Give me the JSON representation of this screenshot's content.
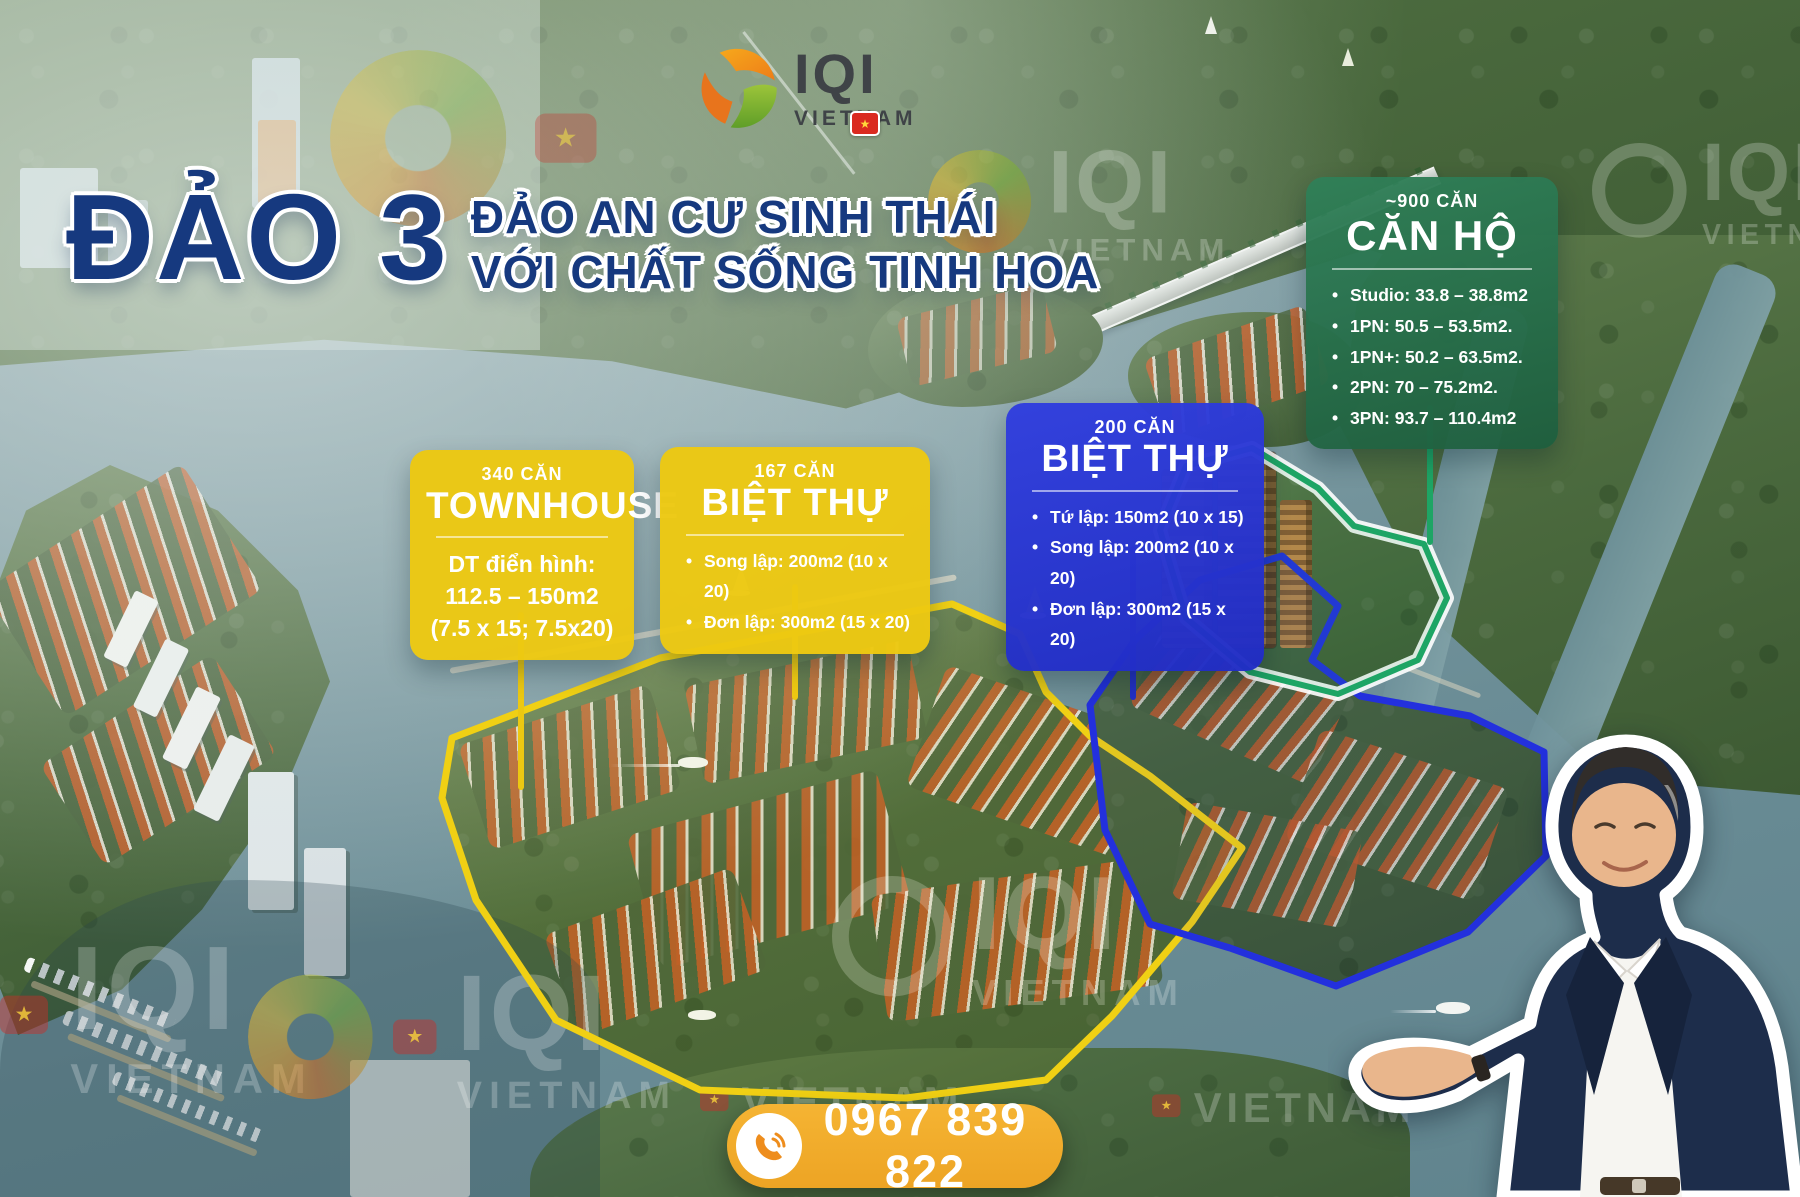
{
  "logo": {
    "brand": "IQI",
    "region": "VIETNAM",
    "flag_star": "★"
  },
  "title": {
    "main": "ĐẢO 3",
    "sub1": "ĐẢO AN CƯ SINH THÁI",
    "sub2": "VỚI CHẤT SỐNG TINH HOA"
  },
  "cards": {
    "apartment": {
      "count": "~900 CĂN",
      "title": "CĂN HỘ",
      "items": [
        "Studio: 33.8 – 38.8m2",
        "1PN: 50.5 – 53.5m2.",
        "1PN+: 50.2 – 63.5m2.",
        "2PN: 70 – 75.2m2.",
        "3PN: 93.7 – 110.4m2"
      ]
    },
    "villa_blue": {
      "count": "200 CĂN",
      "title": "BIỆT THỰ",
      "items": [
        "Tứ lập: 150m2 (10 x 15)",
        "Song lập: 200m2 (10 x 20)",
        "Đơn lập: 300m2 (15 x 20)"
      ]
    },
    "townhouse": {
      "count": "340 CĂN",
      "title": "TOWNHOUSE",
      "lines": [
        "DT điển hình:",
        "112.5 – 150m2",
        "(7.5 x 15; 7.5x20)"
      ]
    },
    "villa_yellow": {
      "count": "167 CĂN",
      "title": "BIỆT THỰ",
      "items": [
        "Song lập: 200m2 (10 x 20)",
        "Đơn lập: 300m2 (15 x 20)"
      ]
    }
  },
  "contact": {
    "phone": "0967 839 822"
  },
  "watermark": {
    "brand": "IQI",
    "region": "VIETNAM",
    "flag_star": "★"
  },
  "colors": {
    "accent_yellow": "#ecc812",
    "accent_blue": "#2330c8",
    "accent_green": "#1ea565",
    "phone_badge": "#f2ab33",
    "title_navy": "#16397f"
  }
}
